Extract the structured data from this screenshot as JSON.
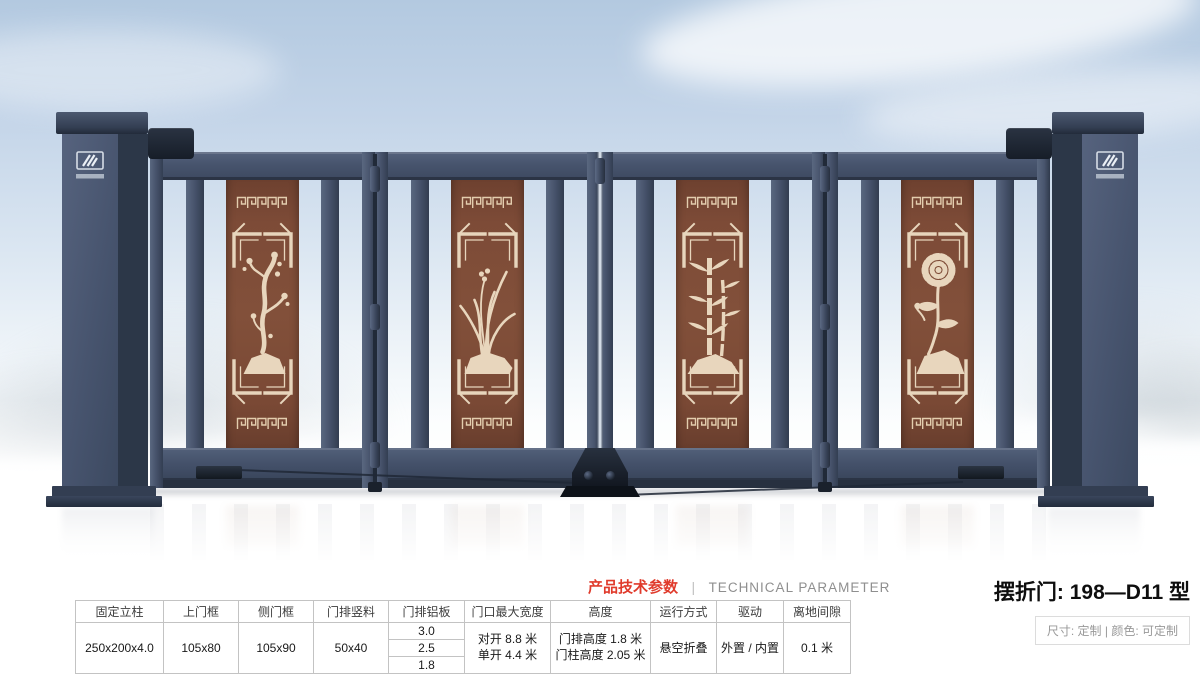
{
  "header": {
    "params_title_cn": "产品技术参数",
    "params_divider": "|",
    "params_title_en": "TECHNICAL PARAMETER",
    "product_title": "摆折门: 198—D11 型",
    "product_spec": "尺寸: 定制 | 颜色: 可定制"
  },
  "table": {
    "columns": [
      {
        "header": "固定立柱",
        "value": "250x200x4.0"
      },
      {
        "header": "上门框",
        "value": "105x80"
      },
      {
        "header": "侧门框",
        "value": "105x90"
      },
      {
        "header": "门排竖料",
        "value": "50x40"
      },
      {
        "header": "门排铝板",
        "values": [
          "3.0",
          "2.5",
          "1.8"
        ]
      },
      {
        "header": "门口最大宽度",
        "lines": [
          "对开 8.8 米",
          "单开 4.4 米"
        ]
      },
      {
        "header": "高度",
        "lines": [
          "门排高度 1.8 米",
          "门柱高度 2.05 米"
        ]
      },
      {
        "header": "运行方式",
        "value": "悬空折叠"
      },
      {
        "header": "驱动",
        "value": "外置 / 内置"
      },
      {
        "header": "离地间隙",
        "value": "0.1 米"
      }
    ]
  },
  "gate": {
    "leaves": 4,
    "panels": [
      {
        "motif": "plum-blossom-motif"
      },
      {
        "motif": "orchid-motif"
      },
      {
        "motif": "bamboo-motif"
      },
      {
        "motif": "chrysanthemum-motif"
      }
    ],
    "badge_icon": "brand-logo",
    "colors": {
      "accent_red": "#e03b2c",
      "gate_frame": "#47536a",
      "gate_frame_dark": "#2c3748",
      "panel_brown": "#7a4936",
      "ornament_cream": "#e7d5bc",
      "sky_top": "#b3c9e0"
    }
  }
}
